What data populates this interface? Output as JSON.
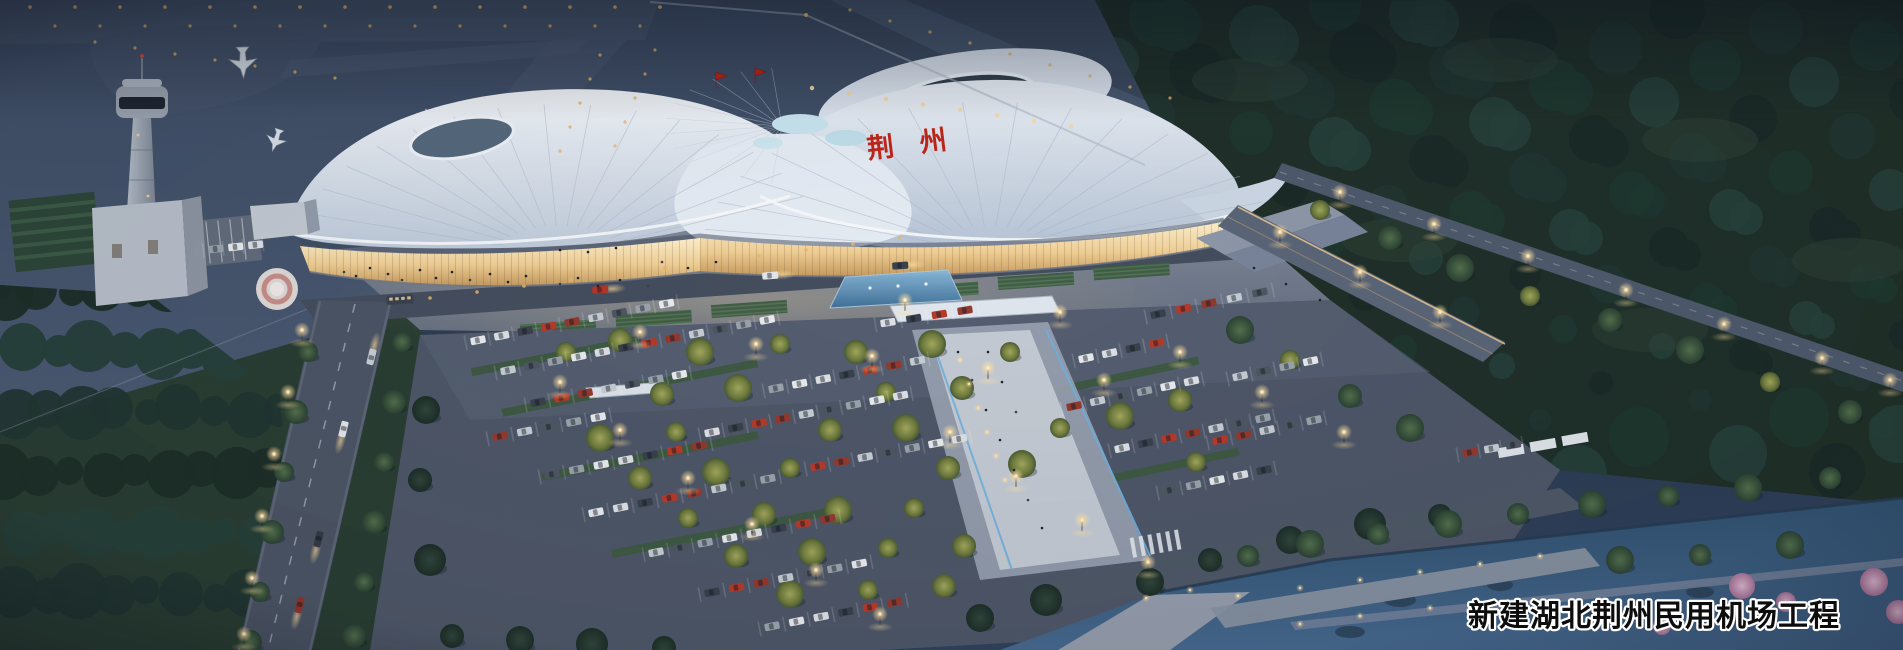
{
  "scene": {
    "caption": "新建湖北荆州民用机场工程",
    "roof_sign": "荆州"
  },
  "colors": {
    "dusk_sky": "#2c3b52",
    "airfield": "#46546c",
    "forest": "#203029",
    "terminal_roof": "#e9eff6",
    "terminal_glass_glow": "#f2d49a",
    "red_accent": "#bb2418",
    "asphalt": "#4e5768",
    "water": "#3a5878",
    "blossom_pink": "#cf9cbd",
    "lit_tree": "#8a8f4e",
    "lamp_glow": "#ffd9a0",
    "caption_fill": "#0d0d0d",
    "caption_stroke": "#ffffff"
  }
}
